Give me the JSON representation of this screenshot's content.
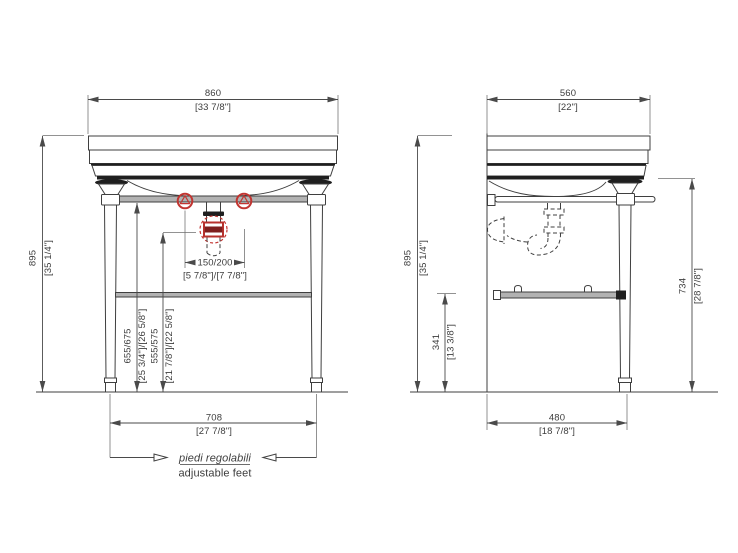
{
  "front_view": {
    "dim_overall_width": {
      "mm": "860",
      "inches": "[33 7/8\"]"
    },
    "dim_overall_height": {
      "mm": "895",
      "inches": "[35 1/4\"]"
    },
    "dim_drain_spacing": {
      "mm": "150/200",
      "inches": "[5 7/8\"]/[7 7/8\"]"
    },
    "dim_supply_height": {
      "mm": "655/675",
      "inches": "[25 3/4\"]/[26 5/8\"]"
    },
    "dim_waste_height": {
      "mm": "555/575",
      "inches": "[21 7/8\"]/[22 5/8\"]"
    },
    "dim_feet_span": {
      "mm": "708",
      "inches": "[27 7/8\"]"
    },
    "note": {
      "italian": "piedi regolabili",
      "english": "adjustable feet"
    }
  },
  "side_view": {
    "dim_overall_depth": {
      "mm": "560",
      "inches": "[22\"]"
    },
    "dim_overall_height": {
      "mm": "895",
      "inches": "[35 1/4\"]"
    },
    "dim_shelf_height": {
      "mm": "341",
      "inches": "[13 3/8\"]"
    },
    "dim_frame_height": {
      "mm": "734",
      "inches": "[28 7/8\"]"
    },
    "dim_feet_depth": {
      "mm": "480",
      "inches": "[18 7/8\"]"
    }
  },
  "colors": {
    "line": "#3f3f3f",
    "accent_red": "#c23531",
    "metal_gray": "#b2b2b2"
  }
}
